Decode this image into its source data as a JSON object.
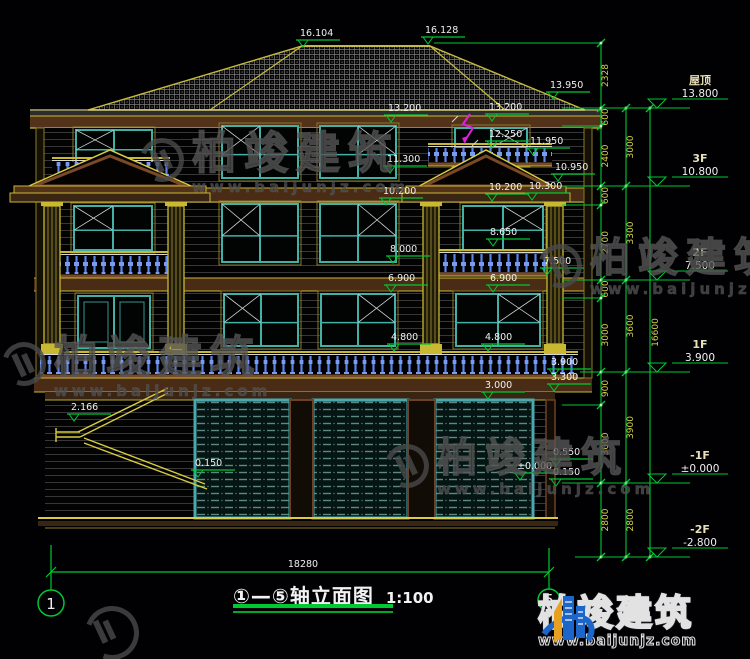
{
  "drawing": {
    "title_axis_range": "①—⑤",
    "title_name": "轴立面图",
    "title_scale": "1:100"
  },
  "axis_bubbles": {
    "left": "1",
    "right": "5"
  },
  "bottom_dimension": "18280",
  "elevation_markers": [
    {
      "label": "16.104",
      "x": 300,
      "y": 33
    },
    {
      "label": "16.128",
      "x": 425,
      "y": 30
    },
    {
      "label": "13.950",
      "x": 550,
      "y": 85
    },
    {
      "label": "13.200",
      "x": 388,
      "y": 108
    },
    {
      "label": "13.200",
      "x": 489,
      "y": 107
    },
    {
      "label": "12.250",
      "x": 489,
      "y": 134
    },
    {
      "label": "11.950",
      "x": 530,
      "y": 141
    },
    {
      "label": "11.300",
      "x": 387,
      "y": 159
    },
    {
      "label": "10.950",
      "x": 555,
      "y": 167
    },
    {
      "label": "10.200",
      "x": 383,
      "y": 191
    },
    {
      "label": "10.200",
      "x": 489,
      "y": 187
    },
    {
      "label": "10.300",
      "x": 529,
      "y": 186
    },
    {
      "label": "8.650",
      "x": 490,
      "y": 232
    },
    {
      "label": "8.000",
      "x": 390,
      "y": 249
    },
    {
      "label": "7.500",
      "x": 544,
      "y": 261
    },
    {
      "label": "6.900",
      "x": 388,
      "y": 278
    },
    {
      "label": "6.900",
      "x": 490,
      "y": 278
    },
    {
      "label": "4.800",
      "x": 391,
      "y": 337
    },
    {
      "label": "4.800",
      "x": 485,
      "y": 337
    },
    {
      "label": "3.900",
      "x": 551,
      "y": 362
    },
    {
      "label": "3.300",
      "x": 551,
      "y": 377
    },
    {
      "label": "3.000",
      "x": 485,
      "y": 385
    },
    {
      "label": "2.166",
      "x": 71,
      "y": 407
    },
    {
      "label": "0.150",
      "x": 195,
      "y": 463
    },
    {
      "label": "0.550",
      "x": 553,
      "y": 452
    },
    {
      "label": "±0.000",
      "x": 517,
      "y": 466
    },
    {
      "label": "0.150",
      "x": 553,
      "y": 472
    }
  ],
  "right_dimensions": {
    "chain_inner": [
      {
        "v": "2328",
        "y1": 43,
        "y2": 108
      },
      {
        "v": "600",
        "y1": 108,
        "y2": 126
      },
      {
        "v": "2400",
        "y1": 126,
        "y2": 186
      },
      {
        "v": "600",
        "y1": 186,
        "y2": 205
      },
      {
        "v": "2700",
        "y1": 205,
        "y2": 280
      },
      {
        "v": "600",
        "y1": 280,
        "y2": 298
      },
      {
        "v": "3000",
        "y1": 298,
        "y2": 372
      },
      {
        "v": "900",
        "y1": 372,
        "y2": 405
      },
      {
        "v": "3000",
        "y1": 405,
        "y2": 483
      },
      {
        "v": "2800",
        "y1": 483,
        "y2": 557
      }
    ],
    "chain_mid": [
      {
        "v": "3000",
        "y1": 108,
        "y2": 186
      },
      {
        "v": "3300",
        "y1": 186,
        "y2": 280
      },
      {
        "v": "3600",
        "y1": 280,
        "y2": 372
      },
      {
        "v": "3900",
        "y1": 372,
        "y2": 483
      },
      {
        "v": "2800",
        "y1": 483,
        "y2": 557
      }
    ],
    "chain_total": [
      {
        "v": "16600",
        "y1": 108,
        "y2": 557
      }
    ]
  },
  "levels": [
    {
      "name": "屋顶",
      "elev": "13.800",
      "y": 108
    },
    {
      "name": "3F",
      "elev": "10.800",
      "y": 186
    },
    {
      "name": "2F",
      "elev": "7.500",
      "y": 280
    },
    {
      "name": "1F",
      "elev": "3.900",
      "y": 372
    },
    {
      "name": "-1F",
      "elev": "±0.000",
      "y": 483
    },
    {
      "name": "-2F",
      "elev": "-2.800",
      "y": 557
    }
  ],
  "watermark": {
    "brand": "柏竣建筑",
    "url": "www.baijunjz.com"
  },
  "logo": {
    "brand": "柏竣建筑",
    "url": "www.baijunjz.com"
  },
  "colors": {
    "dimension_green": "#00c832",
    "cad_yellow": "#d4c83a",
    "window_teal": "#43b0a8",
    "baluster_blue": "#6a92ec",
    "trim_brown": "#7a4a26",
    "text_white": "#f0f0f0",
    "logo_blue": "#1b66c8",
    "logo_orange": "#e8a020",
    "slope_magenta": "#e020e0"
  }
}
